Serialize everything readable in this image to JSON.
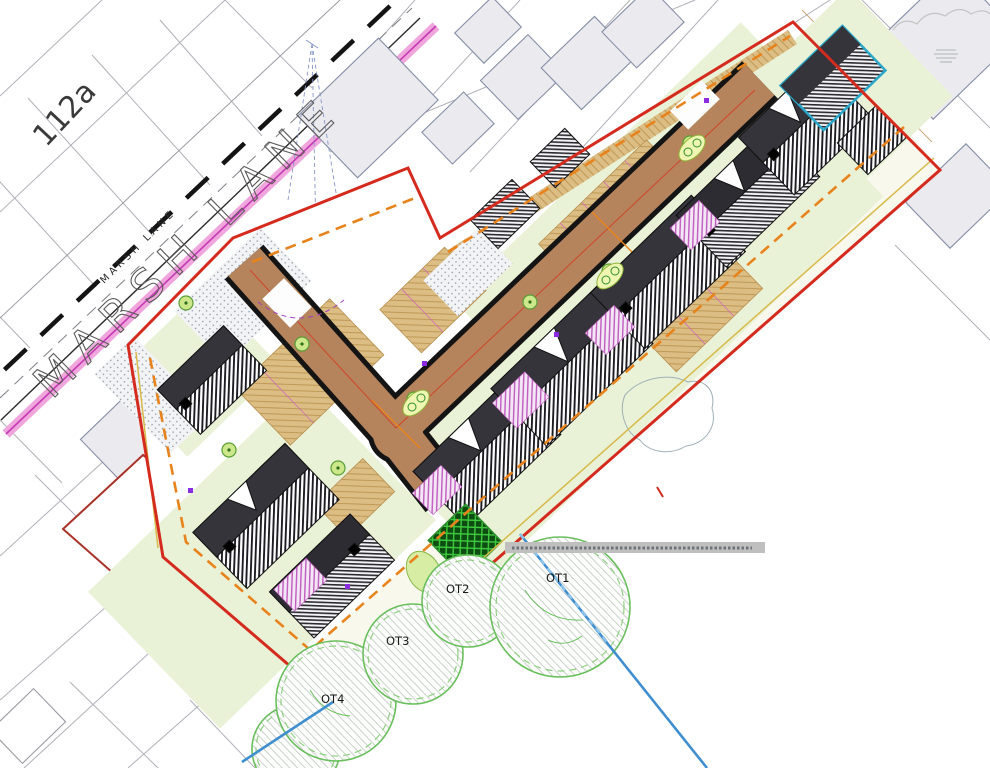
{
  "labels": {
    "house_number": "112a",
    "road_name_large": "MARSH LANE",
    "road_name_small": "MARSH LANE"
  },
  "trees": [
    {
      "id": "OT1",
      "label": "OT1"
    },
    {
      "id": "OT2",
      "label": "OT2"
    },
    {
      "id": "OT3",
      "label": "OT3"
    },
    {
      "id": "OT4",
      "label": "OT4"
    }
  ],
  "colors": {
    "site_boundary_red": "#d42b1e",
    "offset_dashed_orange": "#e8831c",
    "offset_yellow": "#d8b94a",
    "road_surface_brown": "#b5845c",
    "road_edge_black": "#141414",
    "lane_highlight_pink": "#f0a6dc",
    "lane_highlight_magenta": "#c43ab4",
    "garden_green": "#e9f2d6",
    "margin_cream": "#f8f8ec",
    "paving_tan": "#dcbe85",
    "drainage_blue": "#3e8ed0",
    "tree_canopy_green": "#69bf5c",
    "hedge_bright_green": "#3ecb3e",
    "existing_building_grey": "#ebebef",
    "teal_outline": "#2aa7c9",
    "patio_magenta": "#c05cc0"
  }
}
